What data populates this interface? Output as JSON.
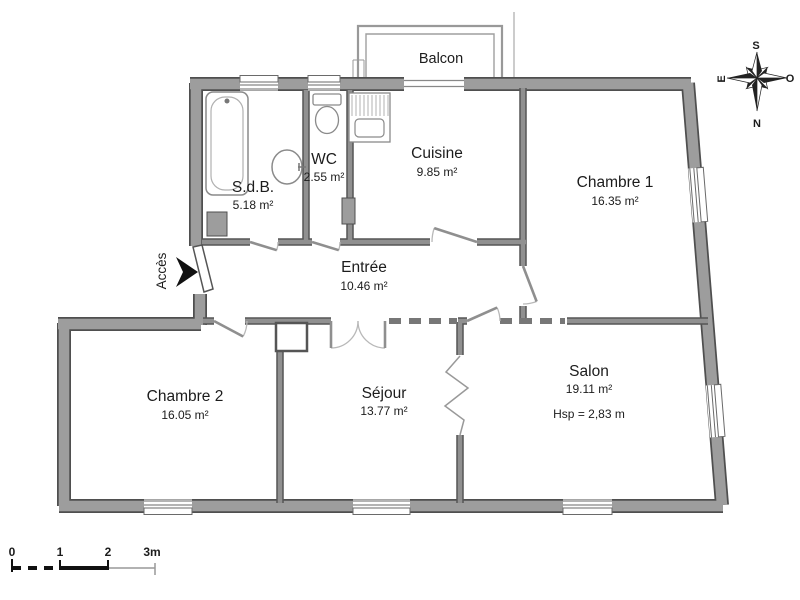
{
  "balcony": {
    "label": "Balcon"
  },
  "access": {
    "label": "Accès"
  },
  "rooms": [
    {
      "id": "sdb",
      "name": "S.d.B.",
      "area": "5.18 m²"
    },
    {
      "id": "wc",
      "name": "WC",
      "area": "2.55 m²"
    },
    {
      "id": "cuisine",
      "name": "Cuisine",
      "area": "9.85 m²"
    },
    {
      "id": "chambre-1",
      "name": "Chambre 1",
      "area": "16.35 m²"
    },
    {
      "id": "entree",
      "name": "Entrée",
      "area": "10.46 m²"
    },
    {
      "id": "chambre-2",
      "name": "Chambre 2",
      "area": "16.05 m²"
    },
    {
      "id": "sejour",
      "name": "Séjour",
      "area": "13.77 m²"
    },
    {
      "id": "salon",
      "name": "Salon",
      "area": "19.11 m²",
      "ceiling_height": "Hsp = 2,83 m"
    }
  ],
  "compass": {
    "top": "S",
    "bottom": "N",
    "left": "E",
    "right": "O"
  },
  "scale_bar": {
    "labels": [
      "0",
      "1",
      "2",
      "3m"
    ]
  },
  "colors": {
    "wall_fill": "#9d9d9d",
    "wall_edge": "#4f4f4f",
    "interior_fill": "#909090",
    "interior_edge": "#555555",
    "fixture": "#8a8a8a",
    "door_leaf": "#8f8f8f",
    "door_arc": "#b8b8b8",
    "frame": "#6a6a6a",
    "text": "#1c1c1c"
  }
}
